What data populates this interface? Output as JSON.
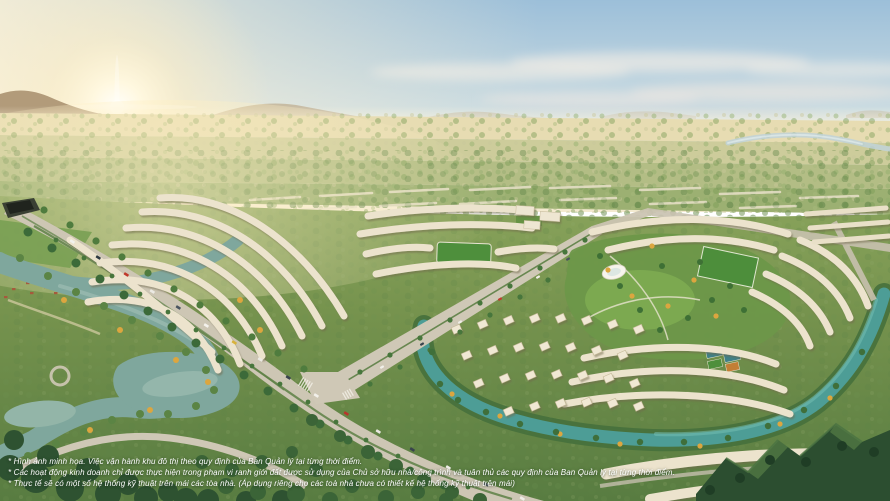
{
  "caption": {
    "lines": [
      "* Hình ảnh minh họa. Việc vận hành khu đô thị theo quy định của Ban Quản lý tại từng thời điểm.",
      "* Các hoạt động kinh doanh chỉ được thực hiện trong phạm vi ranh giới đất được sử dụng của Chủ sở hữu nhà/công trình và tuân thủ các quy định của Ban Quản lý tại từng thời điểm.",
      "* Thực tế sẽ có một số hệ thống kỹ thuật trên mái các tòa nhà. (Áp dụng riêng cho các toà nhà chưa có thiết kế hệ thống kỹ thuật trên mái)"
    ]
  },
  "palette": {
    "sky_top": "#9cbfd9",
    "sky_mid": "#cddde2",
    "sky_horizon": "#f4ead0",
    "sun_glow": "#fff8e0",
    "mountain": "#a08664",
    "river_west": "#7fa79d",
    "canal_east": "#4d9d96",
    "road": "#cdc6b4",
    "forest_dark": "#2e5231",
    "building": "#ece3cd",
    "autumn_accent": "#dca63f"
  }
}
